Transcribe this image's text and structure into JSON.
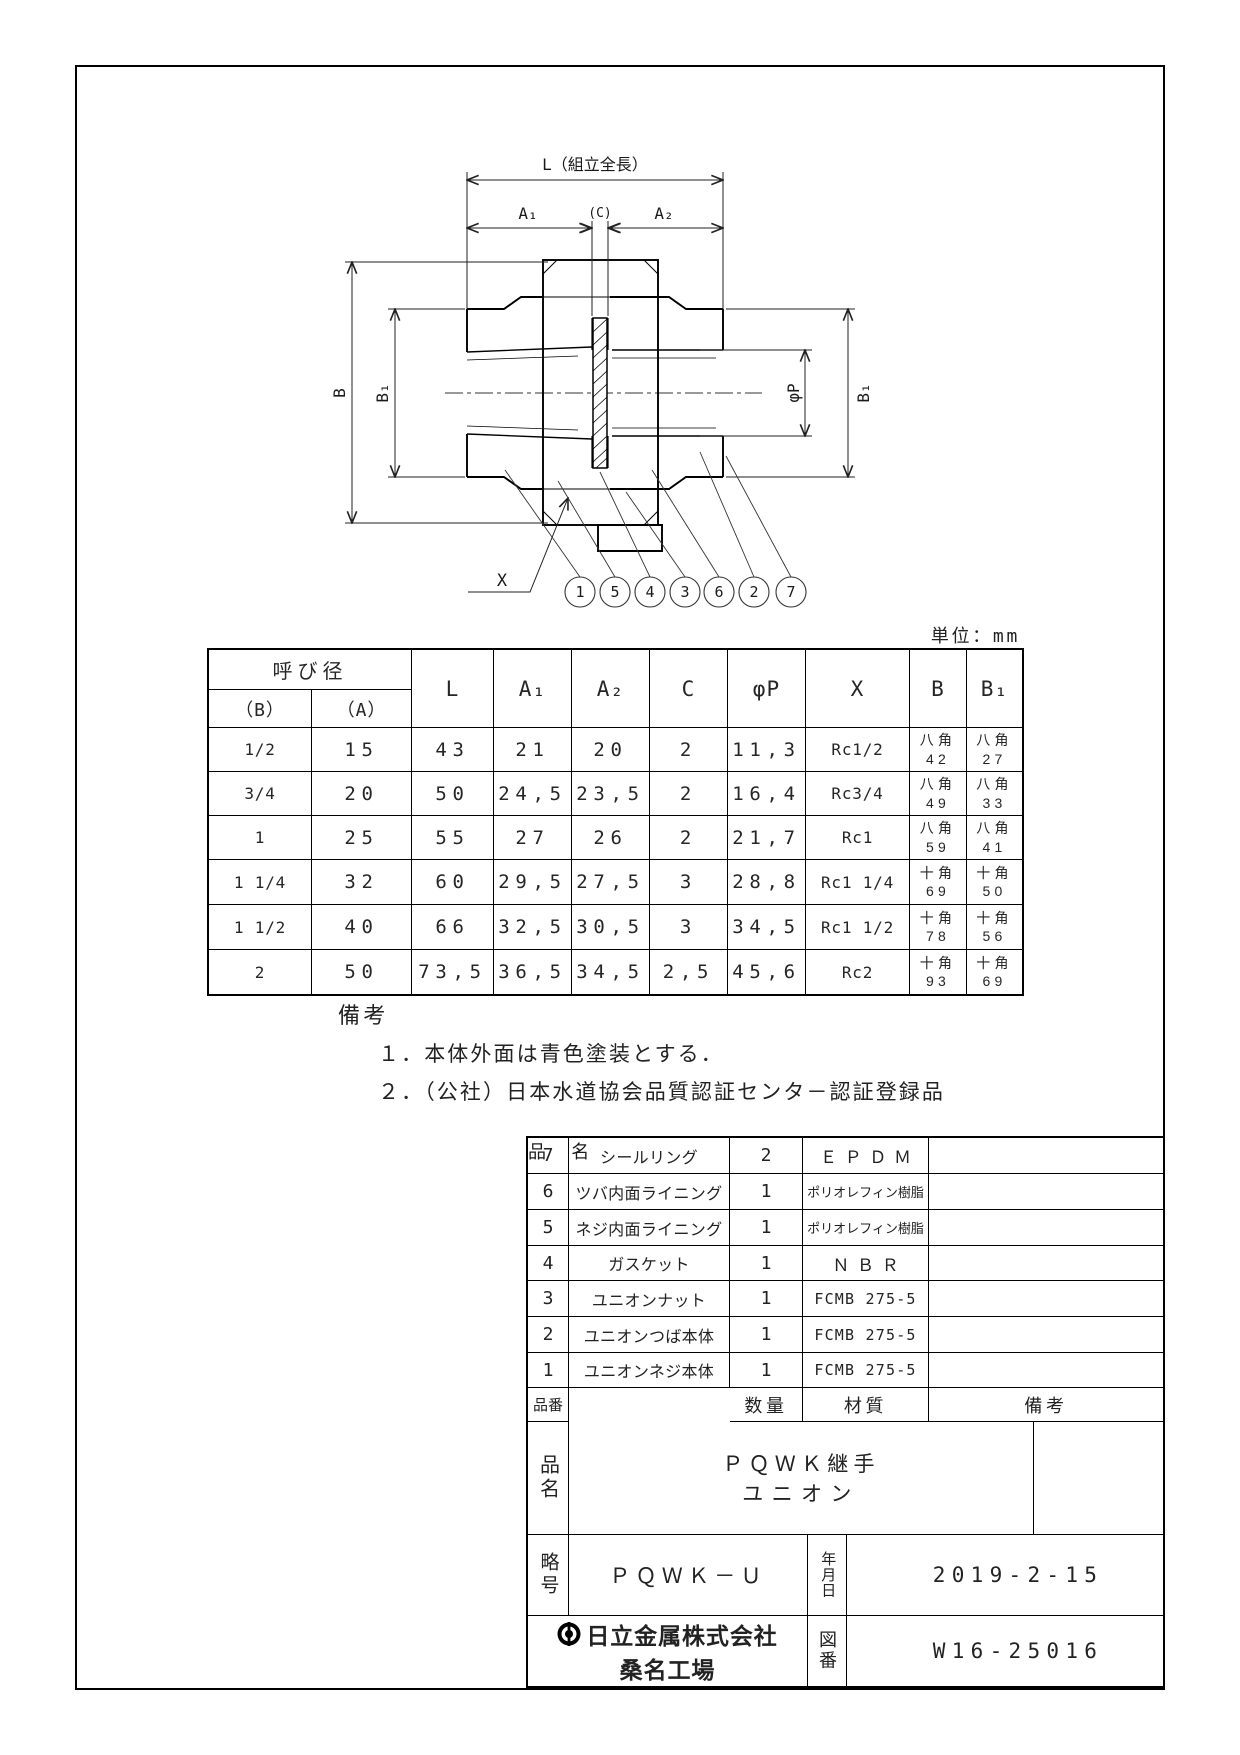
{
  "drawing": {
    "dim_labels": {
      "l": "L（組立全長）",
      "a1": "A₁",
      "c": "(C)",
      "a2": "A₂",
      "b": "B",
      "b1_left": "B₁",
      "phi_p": "φP",
      "b1_right": "B₁",
      "x": "X"
    },
    "balloons": [
      "1",
      "5",
      "4",
      "3",
      "6",
      "2",
      "7"
    ],
    "unit_note": "単位：mm"
  },
  "dim_table": {
    "header": {
      "nominal": "呼び径",
      "b": "（B）",
      "a": "（A）",
      "l": "L",
      "a1": "A₁",
      "a2": "A₂",
      "c": "C",
      "phi_p": "φP",
      "x": "X",
      "bb": "B",
      "b1": "B₁"
    },
    "rows": [
      {
        "b": "1/2",
        "a": "15",
        "l": "43",
        "a1": "21",
        "a2": "20",
        "c": "2",
        "p": "11,3",
        "x": "Rc1/2",
        "bb": "八角\n42",
        "b1": "八角\n27"
      },
      {
        "b": "3/4",
        "a": "20",
        "l": "50",
        "a1": "24,5",
        "a2": "23,5",
        "c": "2",
        "p": "16,4",
        "x": "Rc3/4",
        "bb": "八角\n49",
        "b1": "八角\n33"
      },
      {
        "b": "1",
        "a": "25",
        "l": "55",
        "a1": "27",
        "a2": "26",
        "c": "2",
        "p": "21,7",
        "x": "Rc1",
        "bb": "八角\n59",
        "b1": "八角\n41"
      },
      {
        "b": "1 1/4",
        "a": "32",
        "l": "60",
        "a1": "29,5",
        "a2": "27,5",
        "c": "3",
        "p": "28,8",
        "x": "Rc1 1/4",
        "bb": "十角\n69",
        "b1": "十角\n50"
      },
      {
        "b": "1 1/2",
        "a": "40",
        "l": "66",
        "a1": "32,5",
        "a2": "30,5",
        "c": "3",
        "p": "34,5",
        "x": "Rc1 1/2",
        "bb": "十角\n78",
        "b1": "十角\n56"
      },
      {
        "b": "2",
        "a": "50",
        "l": "73,5",
        "a1": "36,5",
        "a2": "34,5",
        "c": "2,5",
        "p": "45,6",
        "x": "Rc2",
        "bb": "十角\n93",
        "b1": "十角\n69"
      }
    ]
  },
  "remarks": {
    "title": "備考",
    "items": [
      "１．本体外面は青色塗装とする．",
      "２．（公社）日本水道協会品質認証センタ－認証登録品"
    ]
  },
  "parts_table": {
    "header": {
      "no": "品番",
      "name": "品　名",
      "qty": "数量",
      "material": "材質",
      "remarks": "備考"
    },
    "rows": [
      {
        "no": "7",
        "name": "シールリング",
        "qty": "2",
        "material": "ＥＰＤＭ"
      },
      {
        "no": "6",
        "name": "ツバ内面ライニング",
        "qty": "1",
        "material": "ポリオレフィン樹脂"
      },
      {
        "no": "5",
        "name": "ネジ内面ライニング",
        "qty": "1",
        "material": "ポリオレフィン樹脂"
      },
      {
        "no": "4",
        "name": "ガスケット",
        "qty": "1",
        "material": "ＮＢＲ"
      },
      {
        "no": "3",
        "name": "ユニオンナット",
        "qty": "1",
        "material": "FCMB 275-5"
      },
      {
        "no": "2",
        "name": "ユニオンつば本体",
        "qty": "1",
        "material": "FCMB 275-5"
      },
      {
        "no": "1",
        "name": "ユニオンネジ本体",
        "qty": "1",
        "material": "FCMB 275-5"
      }
    ]
  },
  "title_block": {
    "name_label": "品名",
    "product_name_line1": "ＰＱＷＫ継手",
    "product_name_line2": "ユニオン",
    "code_label": "略号",
    "code_value": "ＰＱＷＫ－Ｕ",
    "date_label": "年月日",
    "date_value": "2019-2-15",
    "company_name": "日立金属株式会社",
    "factory_name": "桑名工場",
    "dwg_no_label": "図番",
    "dwg_no_value": "W16-25016"
  }
}
